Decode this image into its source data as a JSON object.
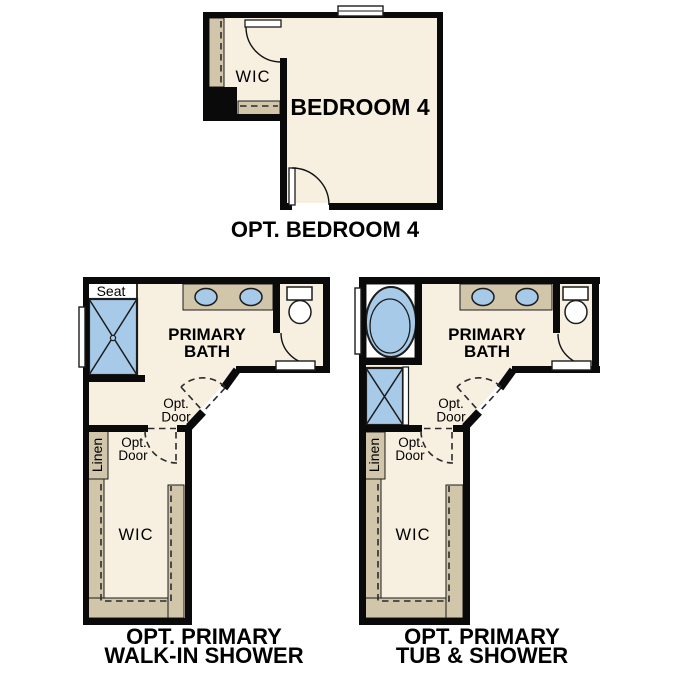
{
  "colors": {
    "paper": "#ffffff",
    "wall": "#0a0a0a",
    "floor": "#f7f0e1",
    "cabinet": "#d1c5aa",
    "fixture": "#a7cae9",
    "outline": "#1c1c1c",
    "dash": "#2b2b2b"
  },
  "plan_bedroom4": {
    "caption": "OPT. BEDROOM 4",
    "wic_label": "WIC",
    "room_label": "BEDROOM 4"
  },
  "plan_walkin_shower": {
    "caption_line1": "OPT. PRIMARY",
    "caption_line2": "WALK-IN SHOWER",
    "seat_label": "Seat",
    "bath_line1": "PRIMARY",
    "bath_line2": "BATH",
    "opt_door_line1": "Opt.",
    "opt_door_line2": "Door",
    "linen_label": "Linen",
    "wic_label": "WIC"
  },
  "plan_tub_shower": {
    "caption_line1": "OPT. PRIMARY",
    "caption_line2": "TUB & SHOWER",
    "bath_line1": "PRIMARY",
    "bath_line2": "BATH",
    "opt_door_line1": "Opt.",
    "opt_door_line2": "Door",
    "linen_label": "Linen",
    "wic_label": "WIC"
  }
}
